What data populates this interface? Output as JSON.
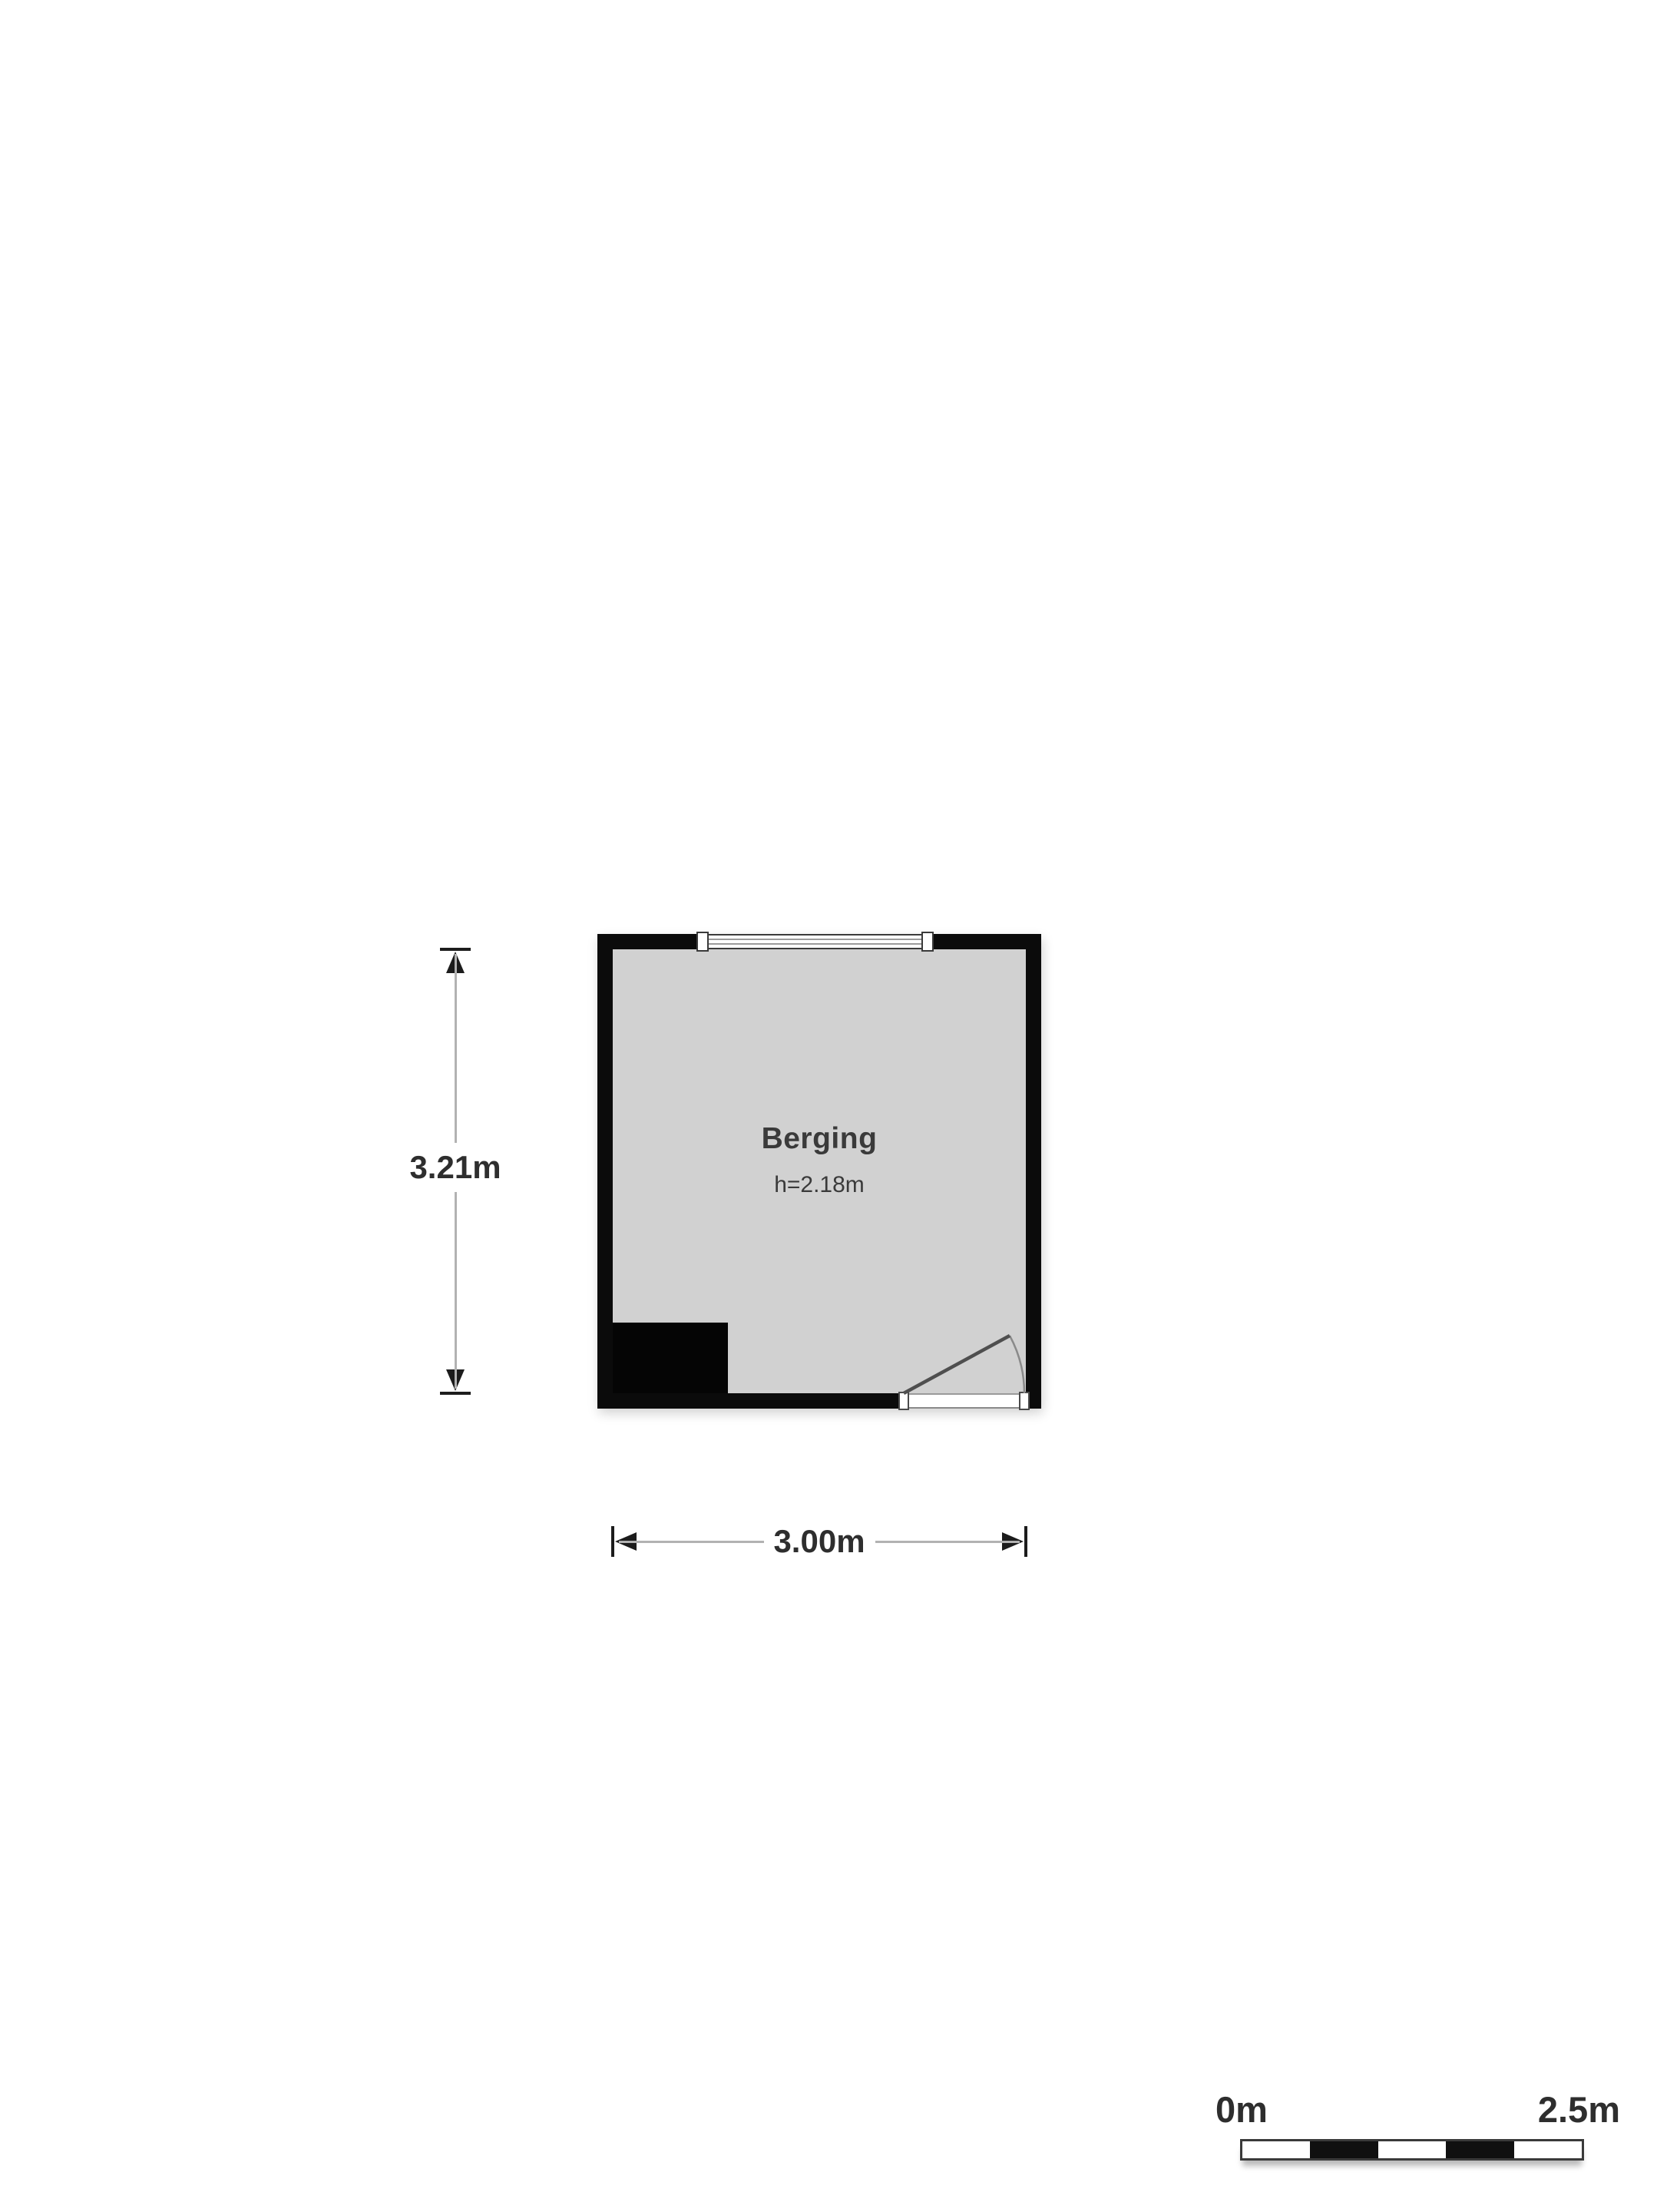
{
  "plan": {
    "room": {
      "name": "Berging",
      "ceiling_height": "h=2.18m"
    },
    "dimensions": {
      "vertical": "3.21m",
      "horizontal": "3.00m"
    }
  },
  "scale_bar": {
    "start": "0m",
    "end": "2.5m"
  },
  "icons": {
    "window": "window",
    "door": "door-swing",
    "arrows": [
      "arrow-up-icon",
      "arrow-down-icon",
      "arrow-left-icon",
      "arrow-right-icon"
    ]
  },
  "colors": {
    "floor": "#d1d1d1",
    "wall": "#0b0b0b",
    "dim-line": "#b2b2b2",
    "dim-marker": "#1c1c1c",
    "dim-text": "#2e2e2e",
    "room-text": "#3a3a3a",
    "door-line": "#4f4f4f",
    "window-border": "#3a3a3a",
    "scale-border": "#3a3a3a",
    "scale-black": "#101010"
  }
}
